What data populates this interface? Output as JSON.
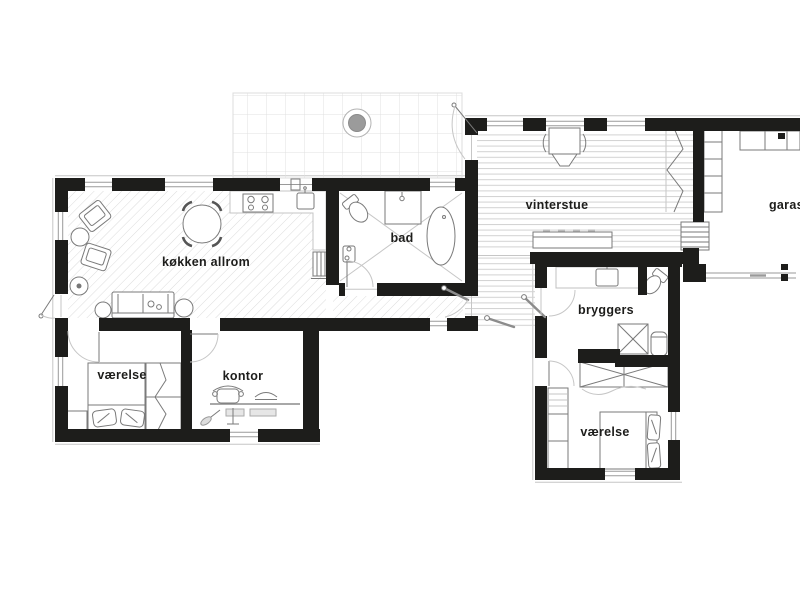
{
  "title": "house floor plan",
  "colors": {
    "wall": "#1d1d1b",
    "text": "#1d1d1b",
    "furn": "#7a7a7a",
    "faint": "#c6c6c6",
    "hatch": "#dcdcdc",
    "plank": "#d2d2d2",
    "tile": "#e0e0e0",
    "accent": "#9b9b9b"
  },
  "rooms": [
    {
      "id": "vinterstue",
      "label": "vinterstue"
    },
    {
      "id": "garasje",
      "label": "garasje"
    },
    {
      "id": "kokken-allrom",
      "label": "køkken allrom"
    },
    {
      "id": "bad",
      "label": "bad"
    },
    {
      "id": "vaerelse-1",
      "label": "værelse"
    },
    {
      "id": "kontor",
      "label": "kontor"
    },
    {
      "id": "bryggers",
      "label": "bryggers"
    },
    {
      "id": "vaerelse-2",
      "label": "værelse"
    }
  ]
}
